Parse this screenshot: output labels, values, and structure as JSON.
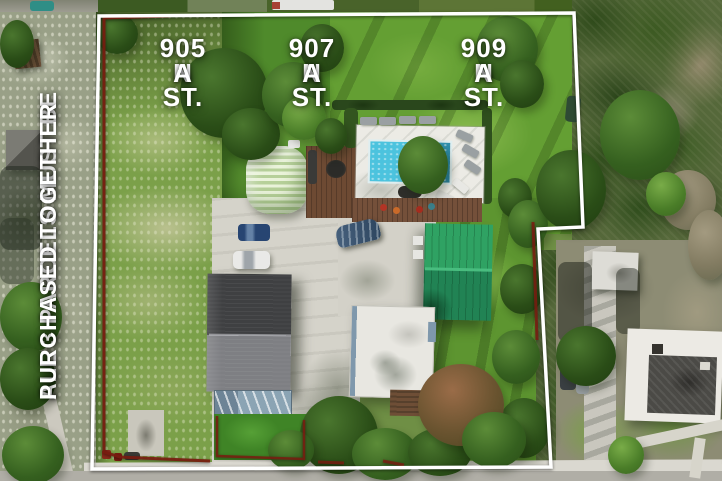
{
  "labels": {
    "parcels": [
      {
        "line1": "905 N",
        "line2": "A ST."
      },
      {
        "line1": "907 N",
        "line2": "A ST."
      },
      {
        "line1": "909 N",
        "line2": "A ST."
      }
    ],
    "side_note": {
      "line1": "ALL 3 PARCELS MUST BE",
      "line2": "PURCHASED TOGETHER"
    }
  },
  "colors": {
    "label_text": "#ffffff",
    "boundary_white": "#ffffff",
    "parcel_line_red": "#7a1c10",
    "pool_water": "#3fb9d9",
    "metal_roof_green": "#28935a",
    "water_tank_green": "#cfe0b8",
    "shingle_roof_gray": "#4a4a4c"
  }
}
